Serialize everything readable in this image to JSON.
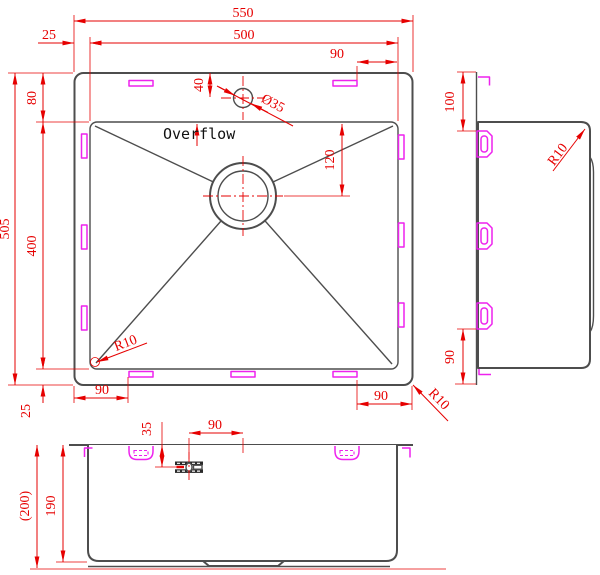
{
  "colors": {
    "dimension_red": "#e60000",
    "outline_gray": "#4d4d4d",
    "clip_magenta": "#ee22ee",
    "detail_black": "#2a2a2a",
    "background": "#ffffff"
  },
  "plan": {
    "dim_overall_width": "550",
    "dim_bowl_width": "500",
    "dim_rim_left": "25",
    "dim_clip_top_right": "90",
    "dim_rim_top": "80",
    "dim_bowl_depth": "400",
    "dim_overall_depth": "505",
    "dim_rim_bottom": "25",
    "dim_clip_bottom_left": "90",
    "dim_clip_bottom_right": "90",
    "dim_faucet_offset": "40",
    "dim_faucet_diameter": "Ø35",
    "dim_drain_offset": "120",
    "overflow_label": "Overflow",
    "radius_bowl_corner": "R10",
    "radius_outer_corner": "R10"
  },
  "side": {
    "dim_clip_top": "100",
    "dim_clip_bottom": "90",
    "radius_corner": "R10"
  },
  "front": {
    "dim_overall_height": "(200)",
    "dim_bowl_height": "190",
    "dim_overflow_depth": "35",
    "dim_overflow_to_faucet": "90"
  }
}
